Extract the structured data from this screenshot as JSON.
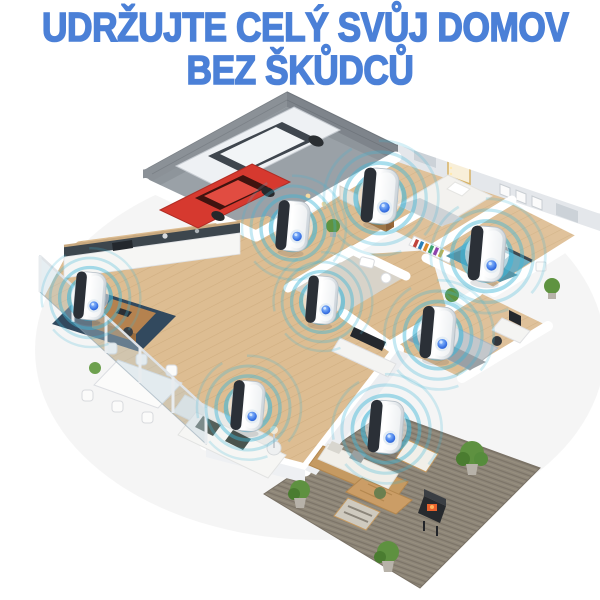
{
  "title": {
    "line1": "UDRŽUJTE CELÝ SVŮJ DOMOV",
    "line2": "BEZ ŠKŮDCŮ"
  },
  "scene": {
    "type": "isometric-home-cutaway-render",
    "device_count": 8,
    "devices": [
      {
        "room": "kitchen",
        "x": 90,
        "y": 296,
        "scale": 0.95
      },
      {
        "room": "entry-hall",
        "x": 293,
        "y": 226,
        "scale": 1.0
      },
      {
        "room": "bedroom-top",
        "x": 380,
        "y": 196,
        "scale": 1.1
      },
      {
        "room": "bedroom-right",
        "x": 487,
        "y": 254,
        "scale": 1.1
      },
      {
        "room": "bathroom",
        "x": 322,
        "y": 300,
        "scale": 0.95
      },
      {
        "room": "bedroom-back",
        "x": 438,
        "y": 333,
        "scale": 1.05
      },
      {
        "room": "living-room",
        "x": 248,
        "y": 406,
        "scale": 1.0
      },
      {
        "room": "patio",
        "x": 386,
        "y": 427,
        "scale": 1.05
      }
    ],
    "vehicles": [
      "white-suv",
      "red-car"
    ],
    "colors": {
      "title": "#4b80d7",
      "ring": "#3fb5d8",
      "led": "#2457d0",
      "wood": "#ddbd92",
      "garage_floor": "#9aa1a7",
      "patio_rug": "#8e8679",
      "navy_rug": "#32495e",
      "blue_bed": "#6fadc0",
      "grey_bed": "#c3c7cb"
    }
  }
}
